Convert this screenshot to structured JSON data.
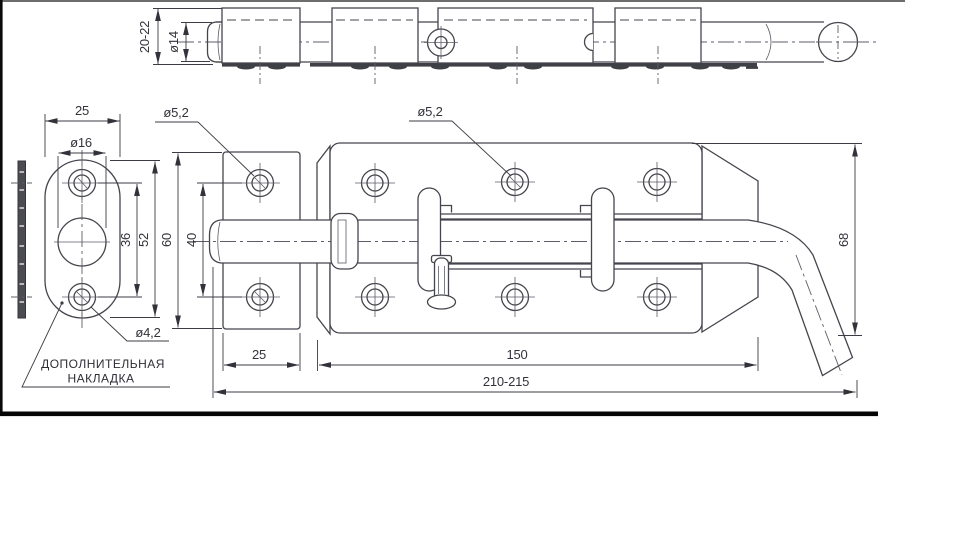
{
  "drawing": {
    "note": {
      "line1": "ДОПОЛНИТЕЛЬНАЯ",
      "line2": "НАКЛАДКА"
    },
    "labels": {
      "top_height_range": "20-22",
      "rod_diameter": "ø14",
      "plate_width": "25",
      "plate_center_hole_dia": "ø16",
      "plate_hole_spacing": "36",
      "plate_height": "52",
      "plate_screw_dia": "ø4,2",
      "keeper_screw_dia": "ø5,2",
      "body_screw_dia": "ø5,2",
      "keeper_height": "60",
      "keeper_screw_spacing": "40",
      "keeper_width": "25",
      "body_length": "150",
      "overall_length": "210-215",
      "body_height": "68"
    },
    "colors": {
      "line": "#45454d",
      "text": "#32323a",
      "frame": "#0a0a0a",
      "background": "#ffffff"
    }
  }
}
